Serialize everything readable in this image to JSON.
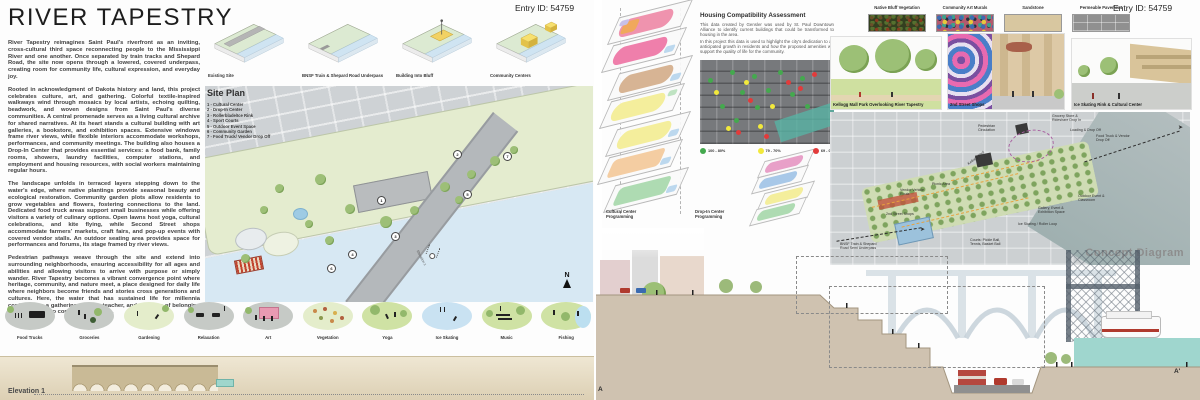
{
  "entry_id": "Entry ID: 54759",
  "left_board": {
    "title": "RIVER TAPESTRY",
    "paragraphs": [
      "River Tapestry reimagines Saint Paul's riverfront as an inviting, cross-cultural third space reconnecting people to the Mississippi River and one another. Once separated by train tracks and Shepard Road, the site now opens through a lowered, covered underpass, creating room for community life, cultural expression, and everyday joy.",
      "Rooted in acknowledgment of Dakota history and land, this project celebrates culture, art, and gathering. Colorful textile-inspired walkways wind through mosaics by local artists, echoing quilting, beadwork, and woven designs from Saint Paul's diverse communities. A central promenade serves as a living cultural archive for shared narratives. At its heart stands a cultural building with art galleries, a bookstore, and exhibition spaces. Extensive windows frame river views, while flexible interiors accommodate workshops, performances, and community meetings. The building also houses a Drop-In Center that provides essential services: a food bank, family rooms, showers, laundry facilities, computer stations, and employment and housing resources, with social workers maintaining regular hours.",
      "The landscape unfolds in terraced layers stepping down to the water's edge, where native plantings provide seasonal beauty and ecological restoration. Community garden plots allow residents to grow vegetables and flowers, fostering connections to the land. Dedicated food truck areas support small businesses while offering visitors a variety of culinary options. Open lawns host yoga, cultural celebrations, and kite flying, while Second Street shops accommodate farmers' markets, craft fairs, and pop-up events with covered vendor stalls. An outdoor seating area provides space for performances and forums, its stage framed by river views.",
      "Pedestrian pathways weave through the site and extend into surrounding neighborhoods, ensuring accessibility for all ages and abilities and allowing visitors to arrive with purpose or simply wander. River Tapestry becomes a vibrant convergence point where heritage, community, and nature meet, a place designed for daily life where neighbors become friends and stories cross generations and cultures. Here, the water that has sustained life for millennia continues as a gathering place, a teacher, and a source of belonging for everyone who comes to its shores."
    ],
    "process_diagrams": [
      "Existing Site",
      "BNSF Train & Shepard Road Underpass",
      "Building Into Bluff",
      "Community Centers"
    ],
    "site_plan": {
      "heading": "Site Plan",
      "legend": [
        "1 - Cultural Center",
        "2 - Drop-In Center",
        "3 - Rollerblade/Ice Rink",
        "4 - Sport Courts",
        "5 - Outdoor Event Space",
        "6 - Community Garden",
        "7 - Food Truck/ Vendor Drop Off"
      ],
      "markers": [
        "1",
        "2",
        "3",
        "4",
        "5",
        "6",
        "7"
      ],
      "north_label": "N",
      "view_marker": "Elevation 1"
    },
    "amenities": [
      "Food Trucks",
      "Groceries",
      "Gardening",
      "Relaxation",
      "Art",
      "Vegetation",
      "Yoga",
      "Ice Skating",
      "Music",
      "Fishing"
    ],
    "elevation_label": "Elevation 1"
  },
  "right_board": {
    "programming": {
      "cultural_label": "Cultural Center Programming",
      "dropin_label": "Drop-In Center Programming"
    },
    "housing": {
      "heading": "Housing Compatibility Assessment",
      "para1": "This data created by Gensler was used by St. Paul Downtown Alliance to identify current buildings that could be transformed to housing in the area.",
      "para2": "In this project this data is used to highlight the city's dedication to an anticipated growth in residents and how the proposed amenities will support the quality of life for the community.",
      "legend": [
        {
          "label": "100 - 80%",
          "color": "#44a94e"
        },
        {
          "label": "79 - 70%",
          "color": "#f2e93c"
        },
        {
          "label": "69 - 0%",
          "color": "#e23b3b"
        }
      ]
    },
    "materials": [
      "Native Bluff Vegetation",
      "Community Art Murals",
      "Sandstone",
      "Permeable Pavement"
    ],
    "renders": [
      "Kellogg Mall Park Overlooking River Tapestry",
      "2nd Street Shops",
      "Ice Skating Rink & Cultural Center"
    ],
    "concept_diagram": {
      "label": "Concept Diagram",
      "annotations": [
        "Pedestrian Circulation",
        "Grocery Store & Rideshare Drop In",
        "Loading & Drop Off",
        "Food Truck & Vendor Drop Off",
        "Vendor Vehicle Route",
        "Picnic Area",
        "2nd Street Shops",
        "Kellogg Blvd",
        "BNSF Train & Shepard Road Semi Underpass",
        "Courts: Pickle Ball, Tennis, Basket Ball",
        "Ice Skating / Roller Loop",
        "Gallery, Event & Exhibition Space",
        "Outdoor Event & Classroom"
      ]
    },
    "section": {
      "label_a": "A",
      "label_a_prime": "A'"
    }
  }
}
